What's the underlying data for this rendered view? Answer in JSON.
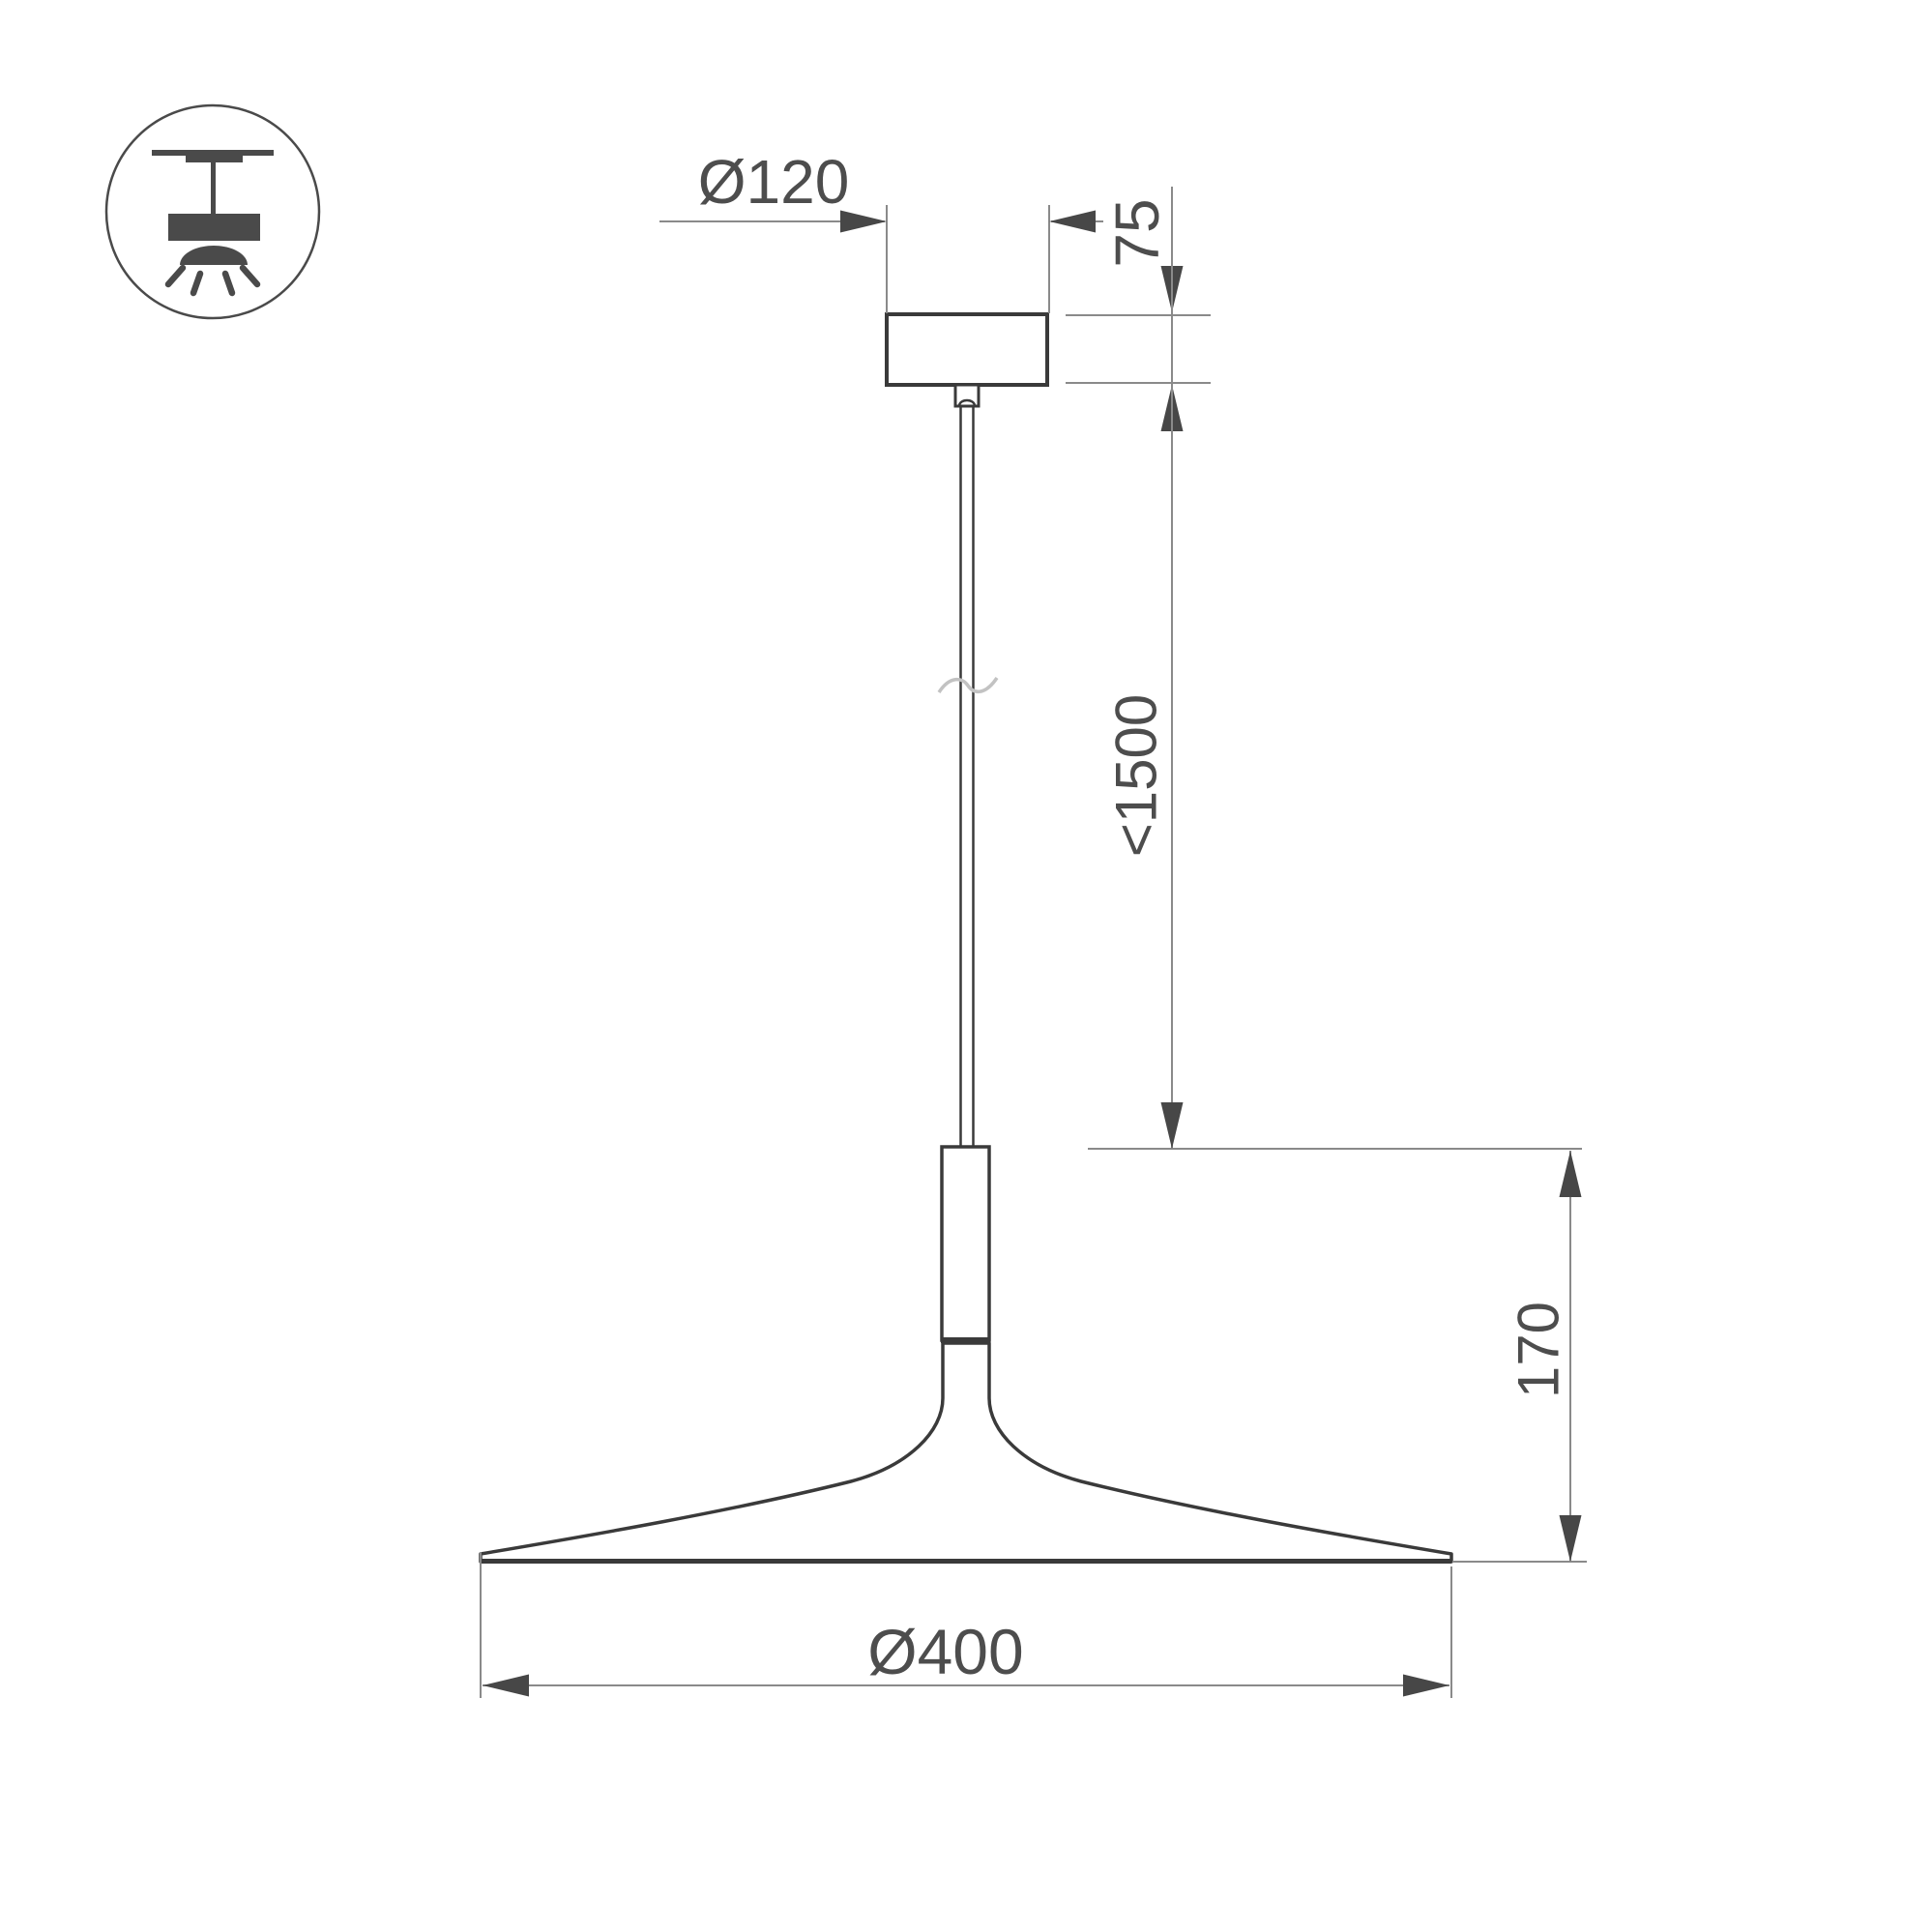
{
  "drawing": {
    "name": "pendant-luminaire-dimension-drawing",
    "labels": {
      "canopy_diameter": "Ø120",
      "canopy_height": "75",
      "max_suspension": "<1500",
      "shade_height": "170",
      "shade_diameter": "Ø400"
    },
    "icon": {
      "name": "ceiling-pendant-mount-icon"
    },
    "colors": {
      "outline": "#3a3a3a",
      "dimension_line": "#8a8a8a",
      "arrowhead": "#474747",
      "text": "#4d4d4d",
      "icon": "#4a4a4a",
      "background": "#ffffff"
    }
  }
}
